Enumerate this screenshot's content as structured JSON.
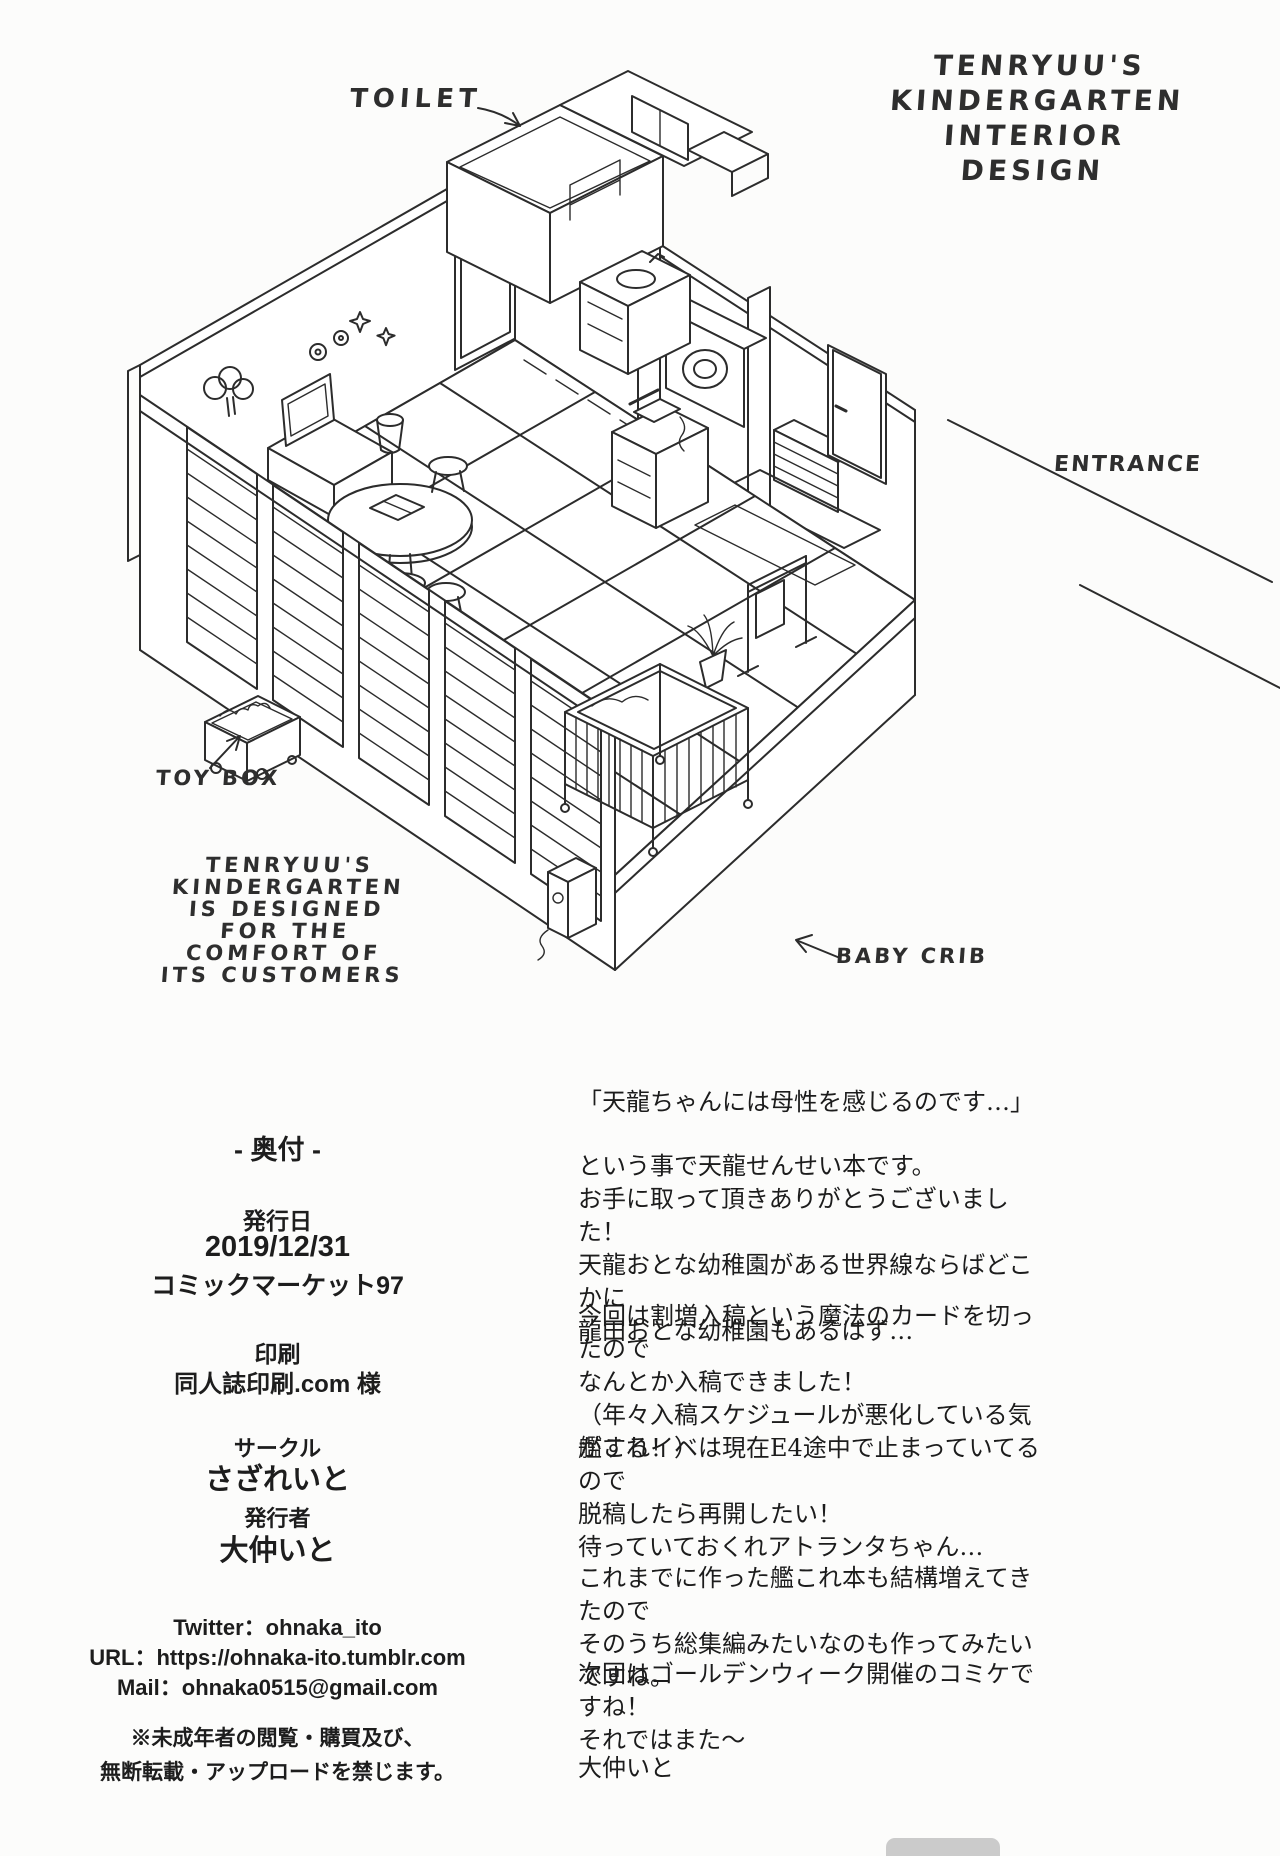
{
  "page": {
    "background": "#fcfcfb",
    "ink": "#2c2c2c"
  },
  "drawing": {
    "title": "TENRYUU'S\nKINDERGARTEN\nINTERIOR\nDESIGN",
    "caption": "TENRYUU'S\nKINDERGARTEN\nIS DESIGNED\nFOR THE\nCOMFORT OF\nITS CUSTOMERS",
    "labels": {
      "toilet": "TOILET",
      "entrance": "ENTRANCE",
      "toy_box": "TOY BOX",
      "baby_crib": "BABY CRIB"
    }
  },
  "colophon": {
    "heading": "- 奥付 -",
    "issue_label": "発行日",
    "issue_date": "2019/12/31",
    "event": "コミックマーケット97",
    "print_label": "印刷",
    "printer": "同人誌印刷.com 様",
    "circle_label": "サークル",
    "circle_name": "さざれいと",
    "publisher_label": "発行者",
    "publisher_name": "大仲いと",
    "twitter": "Twitter：ohnaka_ito",
    "url": "URL：https://ohnaka-ito.tumblr.com",
    "mail": "Mail：ohnaka0515@gmail.com",
    "notice": "※未成年者の閲覧・購買及び、\n無断転載・アップロードを禁じます。"
  },
  "afterword": {
    "quote": "「天龍ちゃんには母性を感じるのです…」",
    "p1": "という事で天龍せんせい本です。\nお手に取って頂きありがとうございました！\n天龍おとな幼稚園がある世界線ならばどこかに\n龍田おとな幼稚園もあるはず…",
    "p2": "今回は割増入稿という魔法のカードを切ったので\nなんとか入稿できました！\n（年々入稿スケジュールが悪化している気がする！）",
    "p3": "艦これイベは現在E4途中で止まっていてるので\n脱稿したら再開したい！\n待っていておくれアトランタちゃん…",
    "p4": "これまでに作った艦これ本も結構増えてきたので\nそのうち総集編みたいなのも作ってみたいですね。",
    "p5": "次回はゴールデンウィーク開催のコミケですね！\nそれではまた～",
    "signature": "大仲いと"
  }
}
